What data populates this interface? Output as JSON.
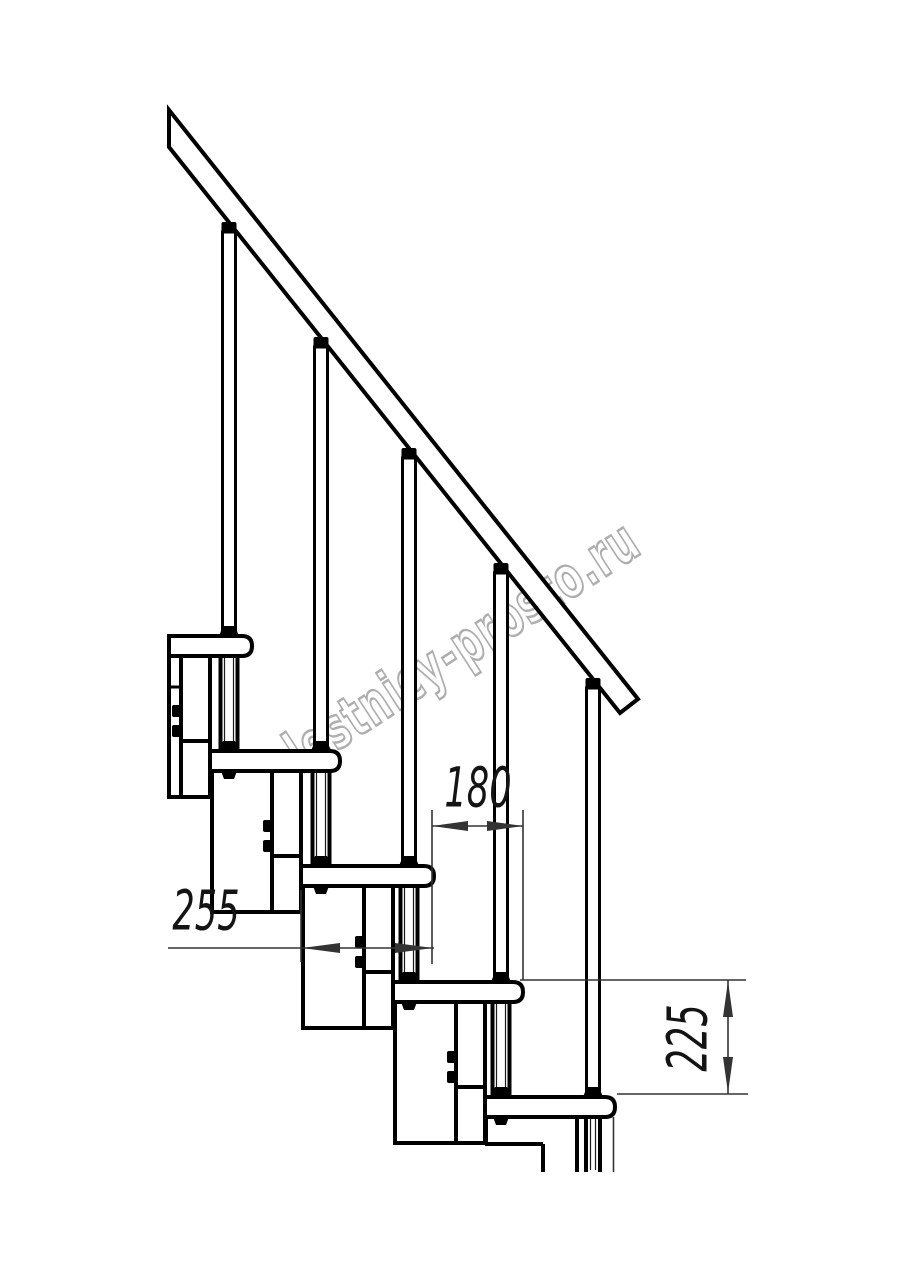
{
  "watermark": {
    "text": "lestnicy-prosto.ru",
    "color": "#a5a5a5"
  },
  "drawing": {
    "type": "staircase-side-view-technical-drawing",
    "background_color": "#ffffff",
    "line_color": "#000000",
    "dimension_line_color": "#333333",
    "treads_count": 5,
    "balusters_count": 5,
    "dimensions": [
      {
        "id": "step-run",
        "value": "180",
        "orientation": "horizontal"
      },
      {
        "id": "tread-depth",
        "value": "255",
        "orientation": "horizontal"
      },
      {
        "id": "riser-height",
        "value": "225",
        "orientation": "vertical-rotated"
      }
    ]
  }
}
